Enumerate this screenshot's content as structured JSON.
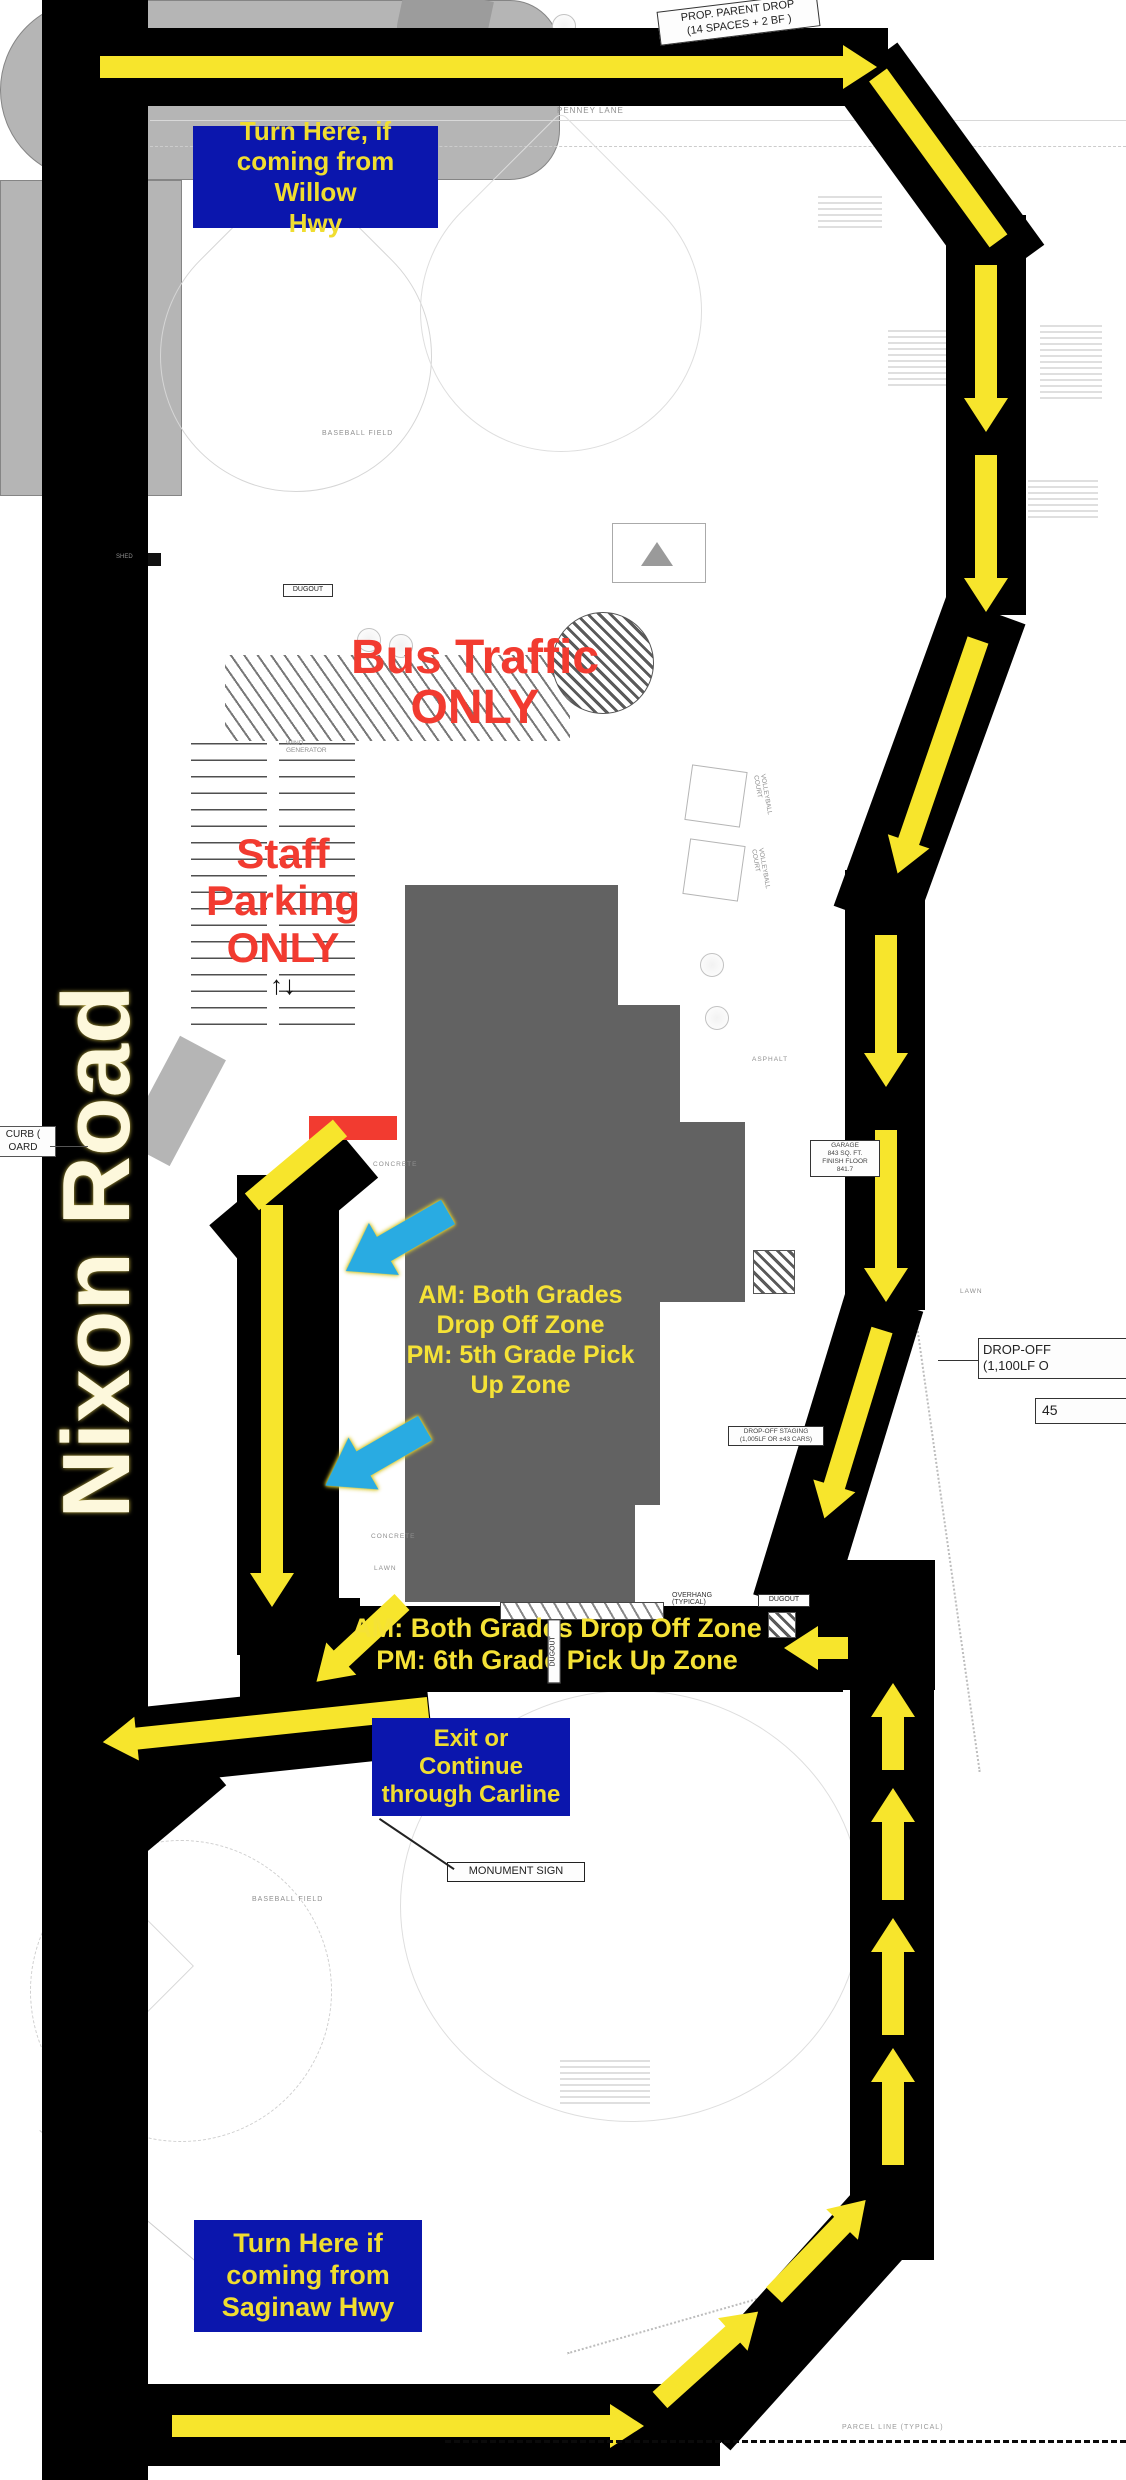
{
  "colors": {
    "road_black": "#000000",
    "arrow_yellow": "#f7e52c",
    "sign_blue": "#0b16ad",
    "sign_text_yellow": "#f0dd30",
    "warning_red": "#f23b30",
    "building_gray": "#626262",
    "pavement_gray": "#b5b5b5",
    "cyan_arrow": "#29abe2"
  },
  "road_name": "Nixon Road",
  "signs": {
    "willow": "Turn Here, if\ncoming from Willow\nHwy",
    "exit": "Exit or\nContinue\nthrough Carline",
    "saginaw": "Turn Here if\ncoming from\nSaginaw Hwy"
  },
  "zones": {
    "bus": "Bus Traffic\nONLY",
    "staff": "Staff\nParking\nONLY",
    "am5": "AM: Both Grades\nDrop Off Zone\nPM: 5th Grade Pick\nUp Zone",
    "am6": "AM: Both Grades Drop Off Zone\nPM: 6th Grade Pick Up Zone"
  },
  "plan_labels": {
    "prop_parent_drop": "PROP. PARENT DROP\n(14 SPACES + 2 BF )",
    "penney_lane": "PENNEY LANE",
    "curb": "CURB (\nOARD",
    "drop_off": "DROP-OFF\n(1,100LF O",
    "num45": "45",
    "monument": "MONUMENT SIGN",
    "baseball": "BASEBALL FIELD",
    "parcel": "PARCEL LINE (TYPICAL)",
    "overhang": "OVERHANG\n(TYPICAL)",
    "dugout": "DUGOUT",
    "staging": "DROP-OFF STAGING\n(1,005LF OR ±43 CARS)",
    "garage": "GARAGE\n843 SQ. FT.\nFINISH FLOOR\n841.7",
    "volleyball": "VOLLEYBALL\nCOURT",
    "lawn": "LAWN",
    "concrete": "CONCRETE",
    "asphalt": "ASPHALT",
    "wind": "WIND\nGENERATOR",
    "shed": "SHED"
  }
}
